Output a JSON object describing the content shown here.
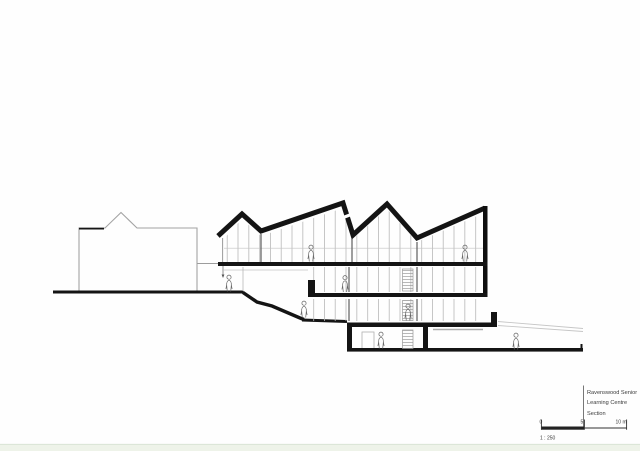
{
  "title_block": {
    "line1": "Ravenswood Senior",
    "line2": "Learning Centre",
    "line3": "Section"
  },
  "scale_bar": {
    "tick_start": "0",
    "tick_mid": "5",
    "tick_end": "10 m",
    "ratio": "1 : 250"
  },
  "colors": {
    "cut_black": "#141414",
    "elevation_gray": "#a3a3a3",
    "mullion_gray": "#b8b8b8",
    "figure_gray": "#666666",
    "footer_strip": "#eef3e9",
    "background": "#fefefe"
  }
}
